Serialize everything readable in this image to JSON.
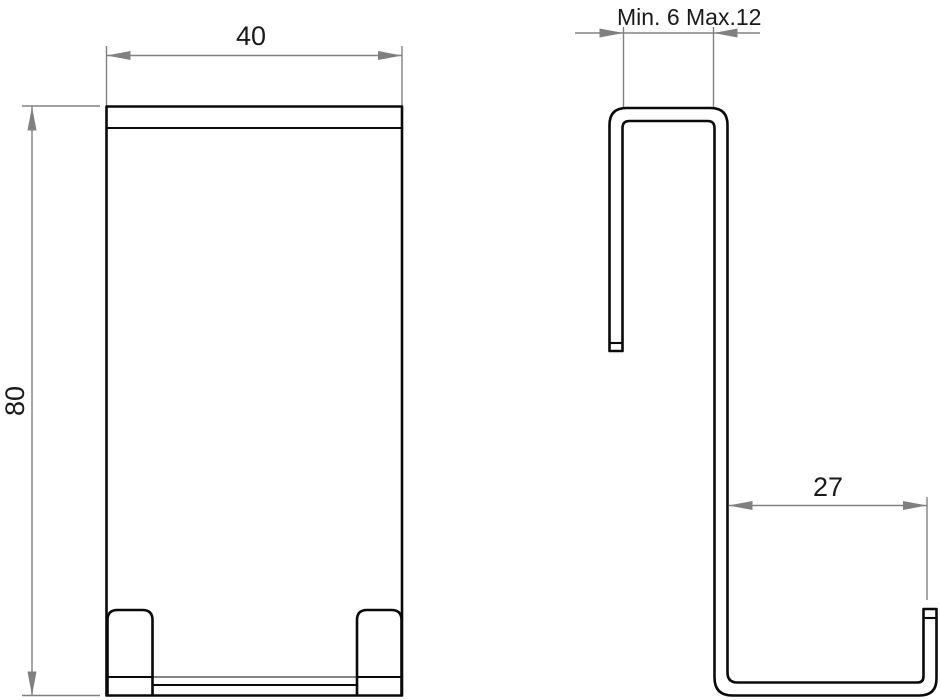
{
  "drawing": {
    "front_view": {
      "width_dim": "40",
      "height_dim": "80"
    },
    "side_view": {
      "door_thickness_dim": "Min. 6 Max.12",
      "depth_dim": "27"
    },
    "colors": {
      "part_line": "#0a0a0a",
      "dimension_line": "#808080",
      "text": "#1a1a1a",
      "background": "#ffffff"
    }
  }
}
